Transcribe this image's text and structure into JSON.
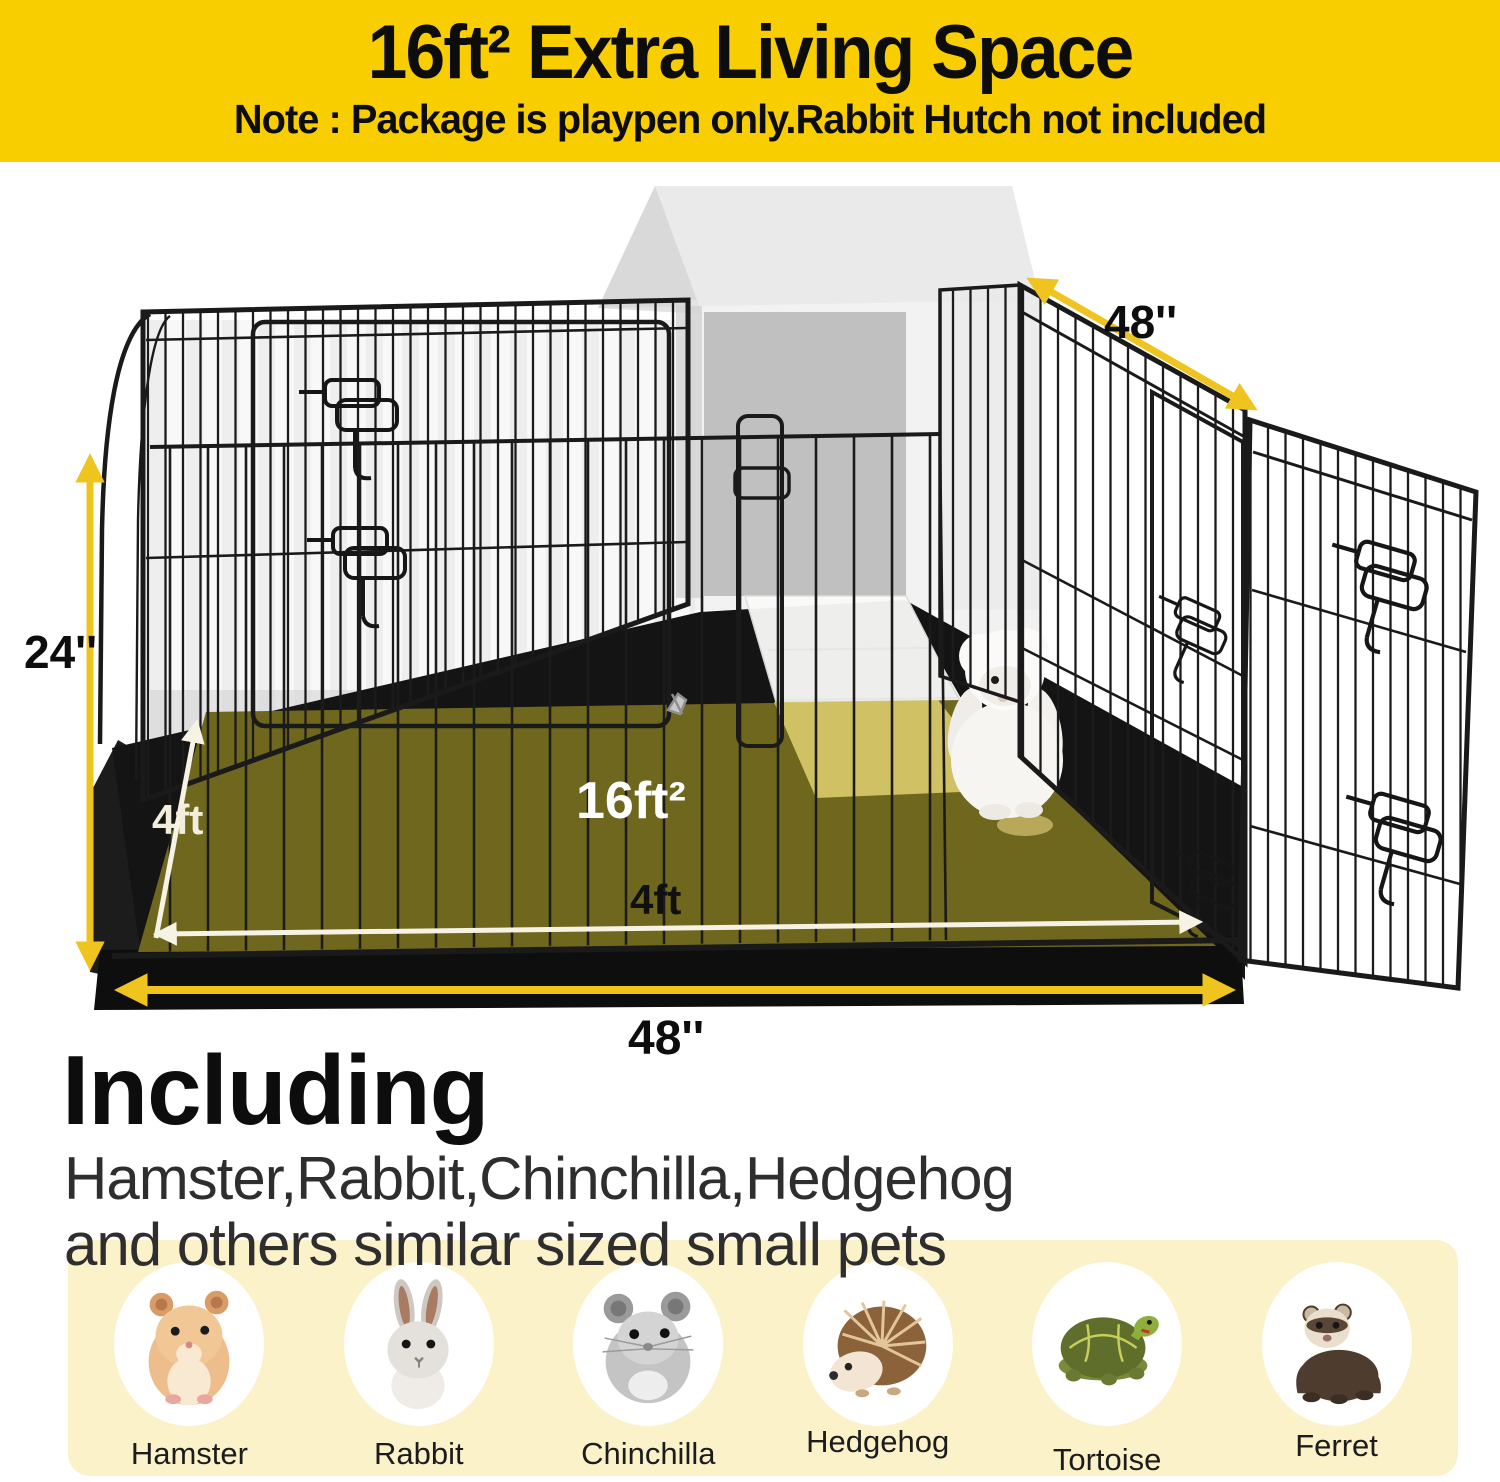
{
  "banner": {
    "title": "16ft² Extra Living Space",
    "note": "Note : Package is playpen only.Rabbit Hutch not included"
  },
  "diagram": {
    "height_label": "24''",
    "side_width_label": "48''",
    "bottom_width_label": "48''",
    "floor_depth_label": "4ft",
    "floor_width_label": "4ft",
    "area_label": "16ft²"
  },
  "including": {
    "heading": "Including",
    "line1": "Hamster,Rabbit,Chinchilla,Hedgehog",
    "line2": "and others similar sized small pets"
  },
  "pets": {
    "items": [
      {
        "label": "Hamster"
      },
      {
        "label": "Rabbit"
      },
      {
        "label": "Chinchilla"
      },
      {
        "label": "Hedgehog"
      },
      {
        "label": "Tortoise"
      },
      {
        "label": "Ferret"
      }
    ]
  },
  "colors": {
    "banner_yellow": "#F9CE00",
    "arrow_yellow": "#EFC41F",
    "floor_olive": "#6F671D",
    "ramp_khaki": "#D8C96B",
    "panel_cream": "#FBF2C9",
    "wire_black": "#1B1B1B"
  }
}
